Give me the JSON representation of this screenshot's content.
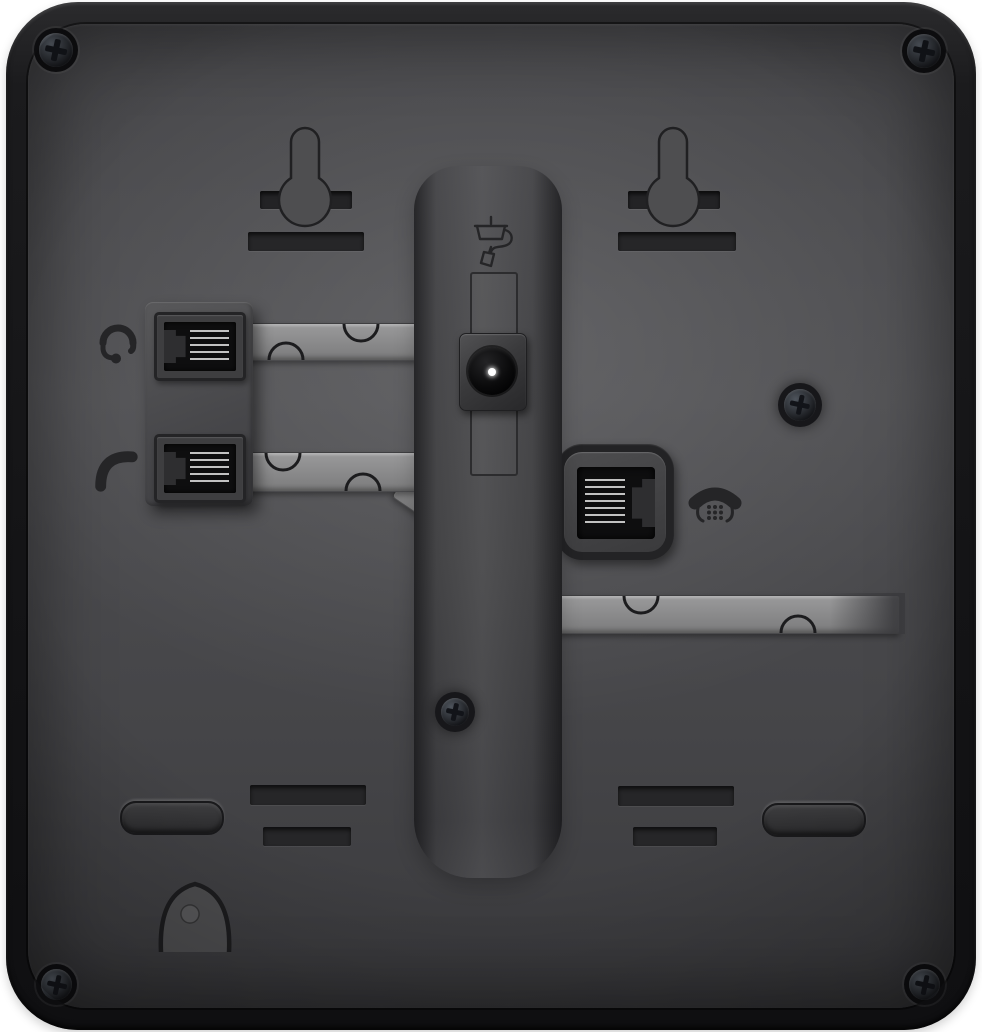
{
  "scene": {
    "description": "Rear view of a black desk telephone showing two wall-mount keyhole slots, headset and handset RJ jacks with cable routing channels, a DC power connector in the stand channel, a telephone line port, mounting slots, rubber feet, a cable hook and six screws"
  },
  "icons": {
    "headset": "headset-icon",
    "handset": "handset-icon",
    "power_adapter": "power-adapter-icon",
    "desk_phone": "desk-phone-icon"
  },
  "ports": {
    "headset": "headset-jack",
    "handset": "handset-jack",
    "power": "dc-power-jack",
    "line": "phone-line-jack"
  },
  "colors": {
    "background": "#ffffff",
    "body": "#1b1b1d",
    "panel": "#48484b",
    "channel": "#8e8e8f",
    "slot": "#232325",
    "opening": "#0e0e0f",
    "pins": "#d6d6d6",
    "icon": "#252527",
    "keyhole": "#4e4e50",
    "power_pin": "#ffffff"
  }
}
